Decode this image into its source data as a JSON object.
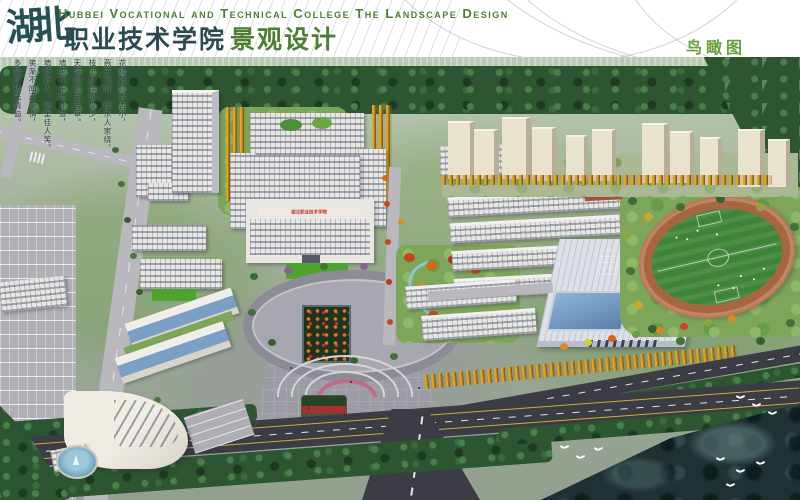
{
  "header": {
    "logo": "湖北",
    "title_en": "Hubbei Vocational and Technical College The Landscape Design",
    "title_cn": "职业技术学院",
    "title_design": "景观设计",
    "view_label": "鸟瞰图"
  },
  "poem": {
    "lines": [
      "花褪残红青杏小，",
      "燕子飞时，绿水人家绕。",
      "枝上柳绵吹又少，",
      "天涯何处无芳草。",
      "墙里秋千墙外道，",
      "墙外行人，墙里佳人笑。",
      "笑渐不闻声渐悄，",
      "多情却被无情恼。"
    ]
  },
  "scene": {
    "banner_text": "湖北职业技术学院"
  },
  "colors": {
    "header-green": "#4e7e35",
    "title-dark": "#2b4a52",
    "label-green": "#67a03c",
    "banner-red": "#c03028",
    "water": "#a9cdd8",
    "forest": "#2e5531",
    "lawn": "#7da65b",
    "bright-lawn": "#4ea32c",
    "road-dark": "#3c3c45",
    "road-light": "#b8b8be",
    "building": "#e9e7e1",
    "tower-cream": "#e8e2cf",
    "track": "#a8663f",
    "field": "#3f8438",
    "gold": "#d9a52f",
    "autumn": "#c2491f",
    "river": "#1f3133"
  }
}
